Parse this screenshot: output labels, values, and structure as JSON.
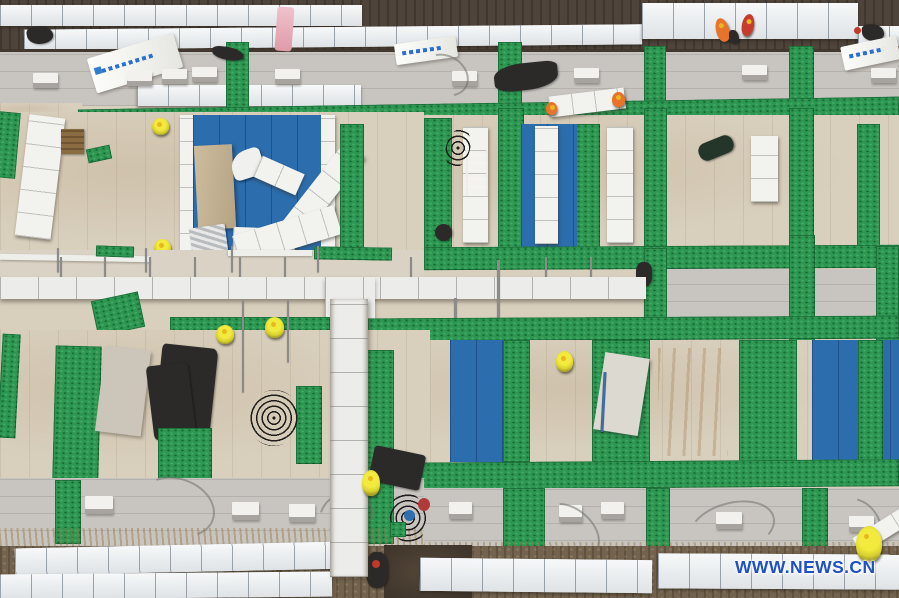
{
  "image": {
    "type": "aerial-photograph",
    "subject": "Top-down aerial view of a modular construction site: white and beige roof modules in rows, green anti-slip walkway mats forming a grid, blue roofing panels, white insulation panel stacks, and workers in hi-vis vests"
  },
  "watermark": {
    "text": "WWW.NEWS.CN",
    "color": "#1e50c6"
  },
  "palette": {
    "road_asphalt": "#4e443b",
    "concrete_gray": "#c8c5c0",
    "insulation_beige": "#d8cfbd",
    "walkway_green": "#2d9752",
    "panel_blue": "#2c6dad",
    "panel_white": "#f2f2ef",
    "dirt_brown": "#73634e",
    "hi_vis_yellow": "#e9e432",
    "hi_vis_orange": "#e8732a",
    "tar_black": "#2b2a28",
    "news_blue": "#1e50c6"
  }
}
